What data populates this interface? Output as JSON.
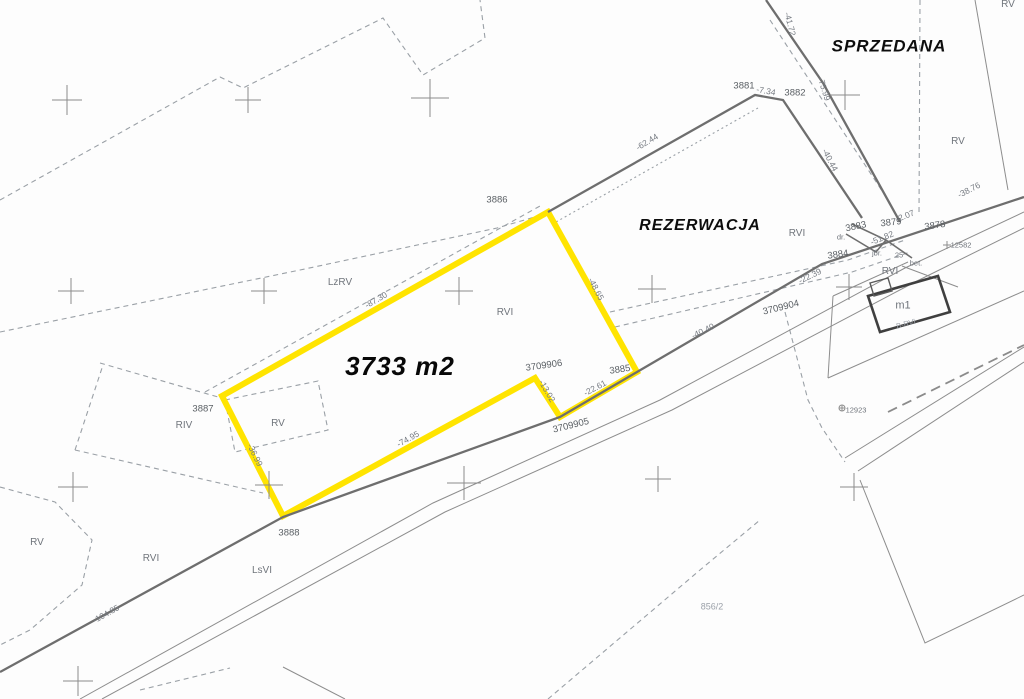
{
  "map": {
    "type": "cadastral-survey-map",
    "highlight_color": "#ffe400",
    "labels": [
      {
        "name": "status-sprzedana",
        "kind": "status",
        "text": "SPRZEDANA",
        "x": 889,
        "y": 46,
        "rot": 0
      },
      {
        "name": "status-rezerwacja",
        "kind": "status",
        "text": "REZERWACJA",
        "x": 700,
        "y": 226,
        "rot": 0,
        "fs": 16
      },
      {
        "name": "plot-area",
        "kind": "area",
        "text": "3733 m2",
        "x": 400,
        "y": 366,
        "rot": 0
      },
      {
        "name": "parcel-3886",
        "kind": "parcel",
        "text": "3886",
        "x": 497,
        "y": 200,
        "rot": 0
      },
      {
        "name": "parcel-3881",
        "kind": "parcel",
        "text": "3881",
        "x": 744,
        "y": 86,
        "rot": 0
      },
      {
        "name": "parcel-3882",
        "kind": "parcel",
        "text": "3882",
        "x": 795,
        "y": 93,
        "rot": 0
      },
      {
        "name": "parcel-3887",
        "kind": "parcel",
        "text": "3887",
        "x": 203,
        "y": 409,
        "rot": 0
      },
      {
        "name": "parcel-3888",
        "kind": "parcel",
        "text": "3888",
        "x": 289,
        "y": 533,
        "rot": 0
      },
      {
        "name": "parcel-3885",
        "kind": "parcel",
        "text": "3885",
        "x": 620,
        "y": 370,
        "rot": -8
      },
      {
        "name": "parcel-3883",
        "kind": "parcel",
        "text": "3883",
        "x": 856,
        "y": 227,
        "rot": -12
      },
      {
        "name": "parcel-3879",
        "kind": "parcel",
        "text": "3879",
        "x": 891,
        "y": 223,
        "rot": -6
      },
      {
        "name": "parcel-3878",
        "kind": "parcel",
        "text": "3878",
        "x": 935,
        "y": 226,
        "rot": -8
      },
      {
        "name": "parcel-3884",
        "kind": "parcel",
        "text": "3884",
        "x": 838,
        "y": 255,
        "rot": -8
      },
      {
        "name": "parcel-3709904",
        "kind": "parcel",
        "text": "3709904",
        "x": 781,
        "y": 308,
        "rot": -14
      },
      {
        "name": "parcel-3709905",
        "kind": "parcel",
        "text": "3709905",
        "x": 571,
        "y": 426,
        "rot": -14
      },
      {
        "name": "parcel-3709906",
        "kind": "parcel",
        "text": "3709906",
        "x": 544,
        "y": 366,
        "rot": -8
      },
      {
        "name": "parcel-856-2",
        "kind": "faint",
        "text": "856/2",
        "x": 712,
        "y": 607,
        "rot": 0
      },
      {
        "name": "point-12582",
        "kind": "small",
        "text": "12582",
        "x": 961,
        "y": 245,
        "rot": 0
      },
      {
        "name": "point-12923",
        "kind": "small",
        "text": "12923",
        "x": 856,
        "y": 410,
        "rot": 0
      },
      {
        "name": "house-number-25",
        "kind": "small",
        "text": "25",
        "x": 899,
        "y": 255,
        "rot": 0
      },
      {
        "name": "building-m1",
        "kind": "soil",
        "text": "m1",
        "x": 903,
        "y": 306,
        "rot": 0,
        "fs": 11
      },
      {
        "name": "dim-7-34",
        "kind": "dim",
        "text": "-7.34",
        "x": 766,
        "y": 91,
        "rot": 10
      },
      {
        "name": "dim-75-99",
        "kind": "dim",
        "text": "-75.99",
        "x": 824,
        "y": 89,
        "rot": 73
      },
      {
        "name": "dim-40-44",
        "kind": "dim",
        "text": "-40.44",
        "x": 830,
        "y": 160,
        "rot": 62
      },
      {
        "name": "dim-41-72",
        "kind": "dim",
        "text": "-41.72",
        "x": 790,
        "y": 24,
        "rot": 76
      },
      {
        "name": "dim-62-44",
        "kind": "dim",
        "text": "-62.44",
        "x": 647,
        "y": 142,
        "rot": -31
      },
      {
        "name": "dim-38-76",
        "kind": "dim",
        "text": "-38.76",
        "x": 969,
        "y": 190,
        "rot": -27
      },
      {
        "name": "dim-22-39",
        "kind": "dim",
        "text": "-22.39",
        "x": 810,
        "y": 276,
        "rot": -26
      },
      {
        "name": "dim-40-40",
        "kind": "dim",
        "text": "-40.40",
        "x": 703,
        "y": 331,
        "rot": -26
      },
      {
        "name": "dim-2-07",
        "kind": "dim",
        "text": "-2.07",
        "x": 905,
        "y": 216,
        "rot": -22
      },
      {
        "name": "dim-51-82",
        "kind": "dim",
        "text": "-51.82",
        "x": 882,
        "y": 238,
        "rot": -22
      },
      {
        "name": "dim-87-30",
        "kind": "dim",
        "text": "-87.30",
        "x": 376,
        "y": 300,
        "rot": -30
      },
      {
        "name": "dim-36-99",
        "kind": "dim",
        "text": "-36.99",
        "x": 255,
        "y": 455,
        "rot": 64
      },
      {
        "name": "dim-74-95",
        "kind": "dim",
        "text": "-74.95",
        "x": 408,
        "y": 439,
        "rot": -29
      },
      {
        "name": "dim-13-02",
        "kind": "dim",
        "text": "-13.02",
        "x": 547,
        "y": 391,
        "rot": 60
      },
      {
        "name": "dim-22-61",
        "kind": "dim",
        "text": "-22.61",
        "x": 595,
        "y": 388,
        "rot": -28
      },
      {
        "name": "dim-48-65",
        "kind": "dim",
        "text": "-48.65",
        "x": 596,
        "y": 289,
        "rot": 62
      },
      {
        "name": "dim-104-85",
        "kind": "dim",
        "text": "-104.85",
        "x": 106,
        "y": 614,
        "rot": -29
      },
      {
        "name": "soil-lzrv",
        "kind": "soil",
        "text": "LzRV",
        "x": 340,
        "y": 283,
        "rot": 0
      },
      {
        "name": "soil-rvi-plot",
        "kind": "soil",
        "text": "RVI",
        "x": 505,
        "y": 313,
        "rot": 0
      },
      {
        "name": "soil-rv-plot",
        "kind": "soil",
        "text": "RV",
        "x": 278,
        "y": 424,
        "rot": 0
      },
      {
        "name": "soil-riv",
        "kind": "soil",
        "text": "RIV",
        "x": 184,
        "y": 426,
        "rot": 0
      },
      {
        "name": "soil-rv-left",
        "kind": "soil",
        "text": "RV",
        "x": 37,
        "y": 543,
        "rot": 0
      },
      {
        "name": "soil-rvi-left",
        "kind": "soil",
        "text": "RVI",
        "x": 151,
        "y": 559,
        "rot": 0
      },
      {
        "name": "soil-lsvi",
        "kind": "soil",
        "text": "LsVI",
        "x": 262,
        "y": 571,
        "rot": 0
      },
      {
        "name": "soil-rvi-mid",
        "kind": "soil",
        "text": "RVI",
        "x": 797,
        "y": 234,
        "rot": 0
      },
      {
        "name": "soil-rv-topright",
        "kind": "soil",
        "text": "RV",
        "x": 958,
        "y": 142,
        "rot": 0
      },
      {
        "name": "soil-rv-corner",
        "kind": "soil",
        "text": "RV",
        "x": 1008,
        "y": 5,
        "rot": 0
      },
      {
        "name": "soil-rvi-junction",
        "kind": "soil",
        "text": "RVI",
        "x": 890,
        "y": 272,
        "rot": 0
      },
      {
        "name": "note-bet",
        "kind": "small",
        "text": "bet.",
        "x": 916,
        "y": 263,
        "rot": 0
      },
      {
        "name": "note-jbr",
        "kind": "small",
        "text": "jbr.",
        "x": 877,
        "y": 253,
        "rot": 0
      },
      {
        "name": "note-dr",
        "kind": "small",
        "text": "dr.",
        "x": 841,
        "y": 237,
        "rot": 0
      },
      {
        "name": "note-b-rvi",
        "kind": "faint",
        "text": "B-RVI",
        "x": 906,
        "y": 324,
        "rot": -15,
        "fs": 7.5
      }
    ],
    "grid_crosses": [
      {
        "x": 67,
        "y": 100,
        "s": 15
      },
      {
        "x": 248,
        "y": 100,
        "s": 13
      },
      {
        "x": 430,
        "y": 98,
        "s": 19
      },
      {
        "x": 845,
        "y": 95,
        "s": 15
      },
      {
        "x": 71,
        "y": 291,
        "s": 13
      },
      {
        "x": 264,
        "y": 291,
        "s": 13
      },
      {
        "x": 459,
        "y": 291,
        "s": 14
      },
      {
        "x": 652,
        "y": 289,
        "s": 14
      },
      {
        "x": 849,
        "y": 287,
        "s": 13
      },
      {
        "x": 73,
        "y": 487,
        "s": 15
      },
      {
        "x": 269,
        "y": 485,
        "s": 14
      },
      {
        "x": 464,
        "y": 483,
        "s": 17
      },
      {
        "x": 658,
        "y": 479,
        "s": 13
      },
      {
        "x": 854,
        "y": 487,
        "s": 14
      },
      {
        "x": 78,
        "y": 681,
        "s": 15
      }
    ]
  }
}
